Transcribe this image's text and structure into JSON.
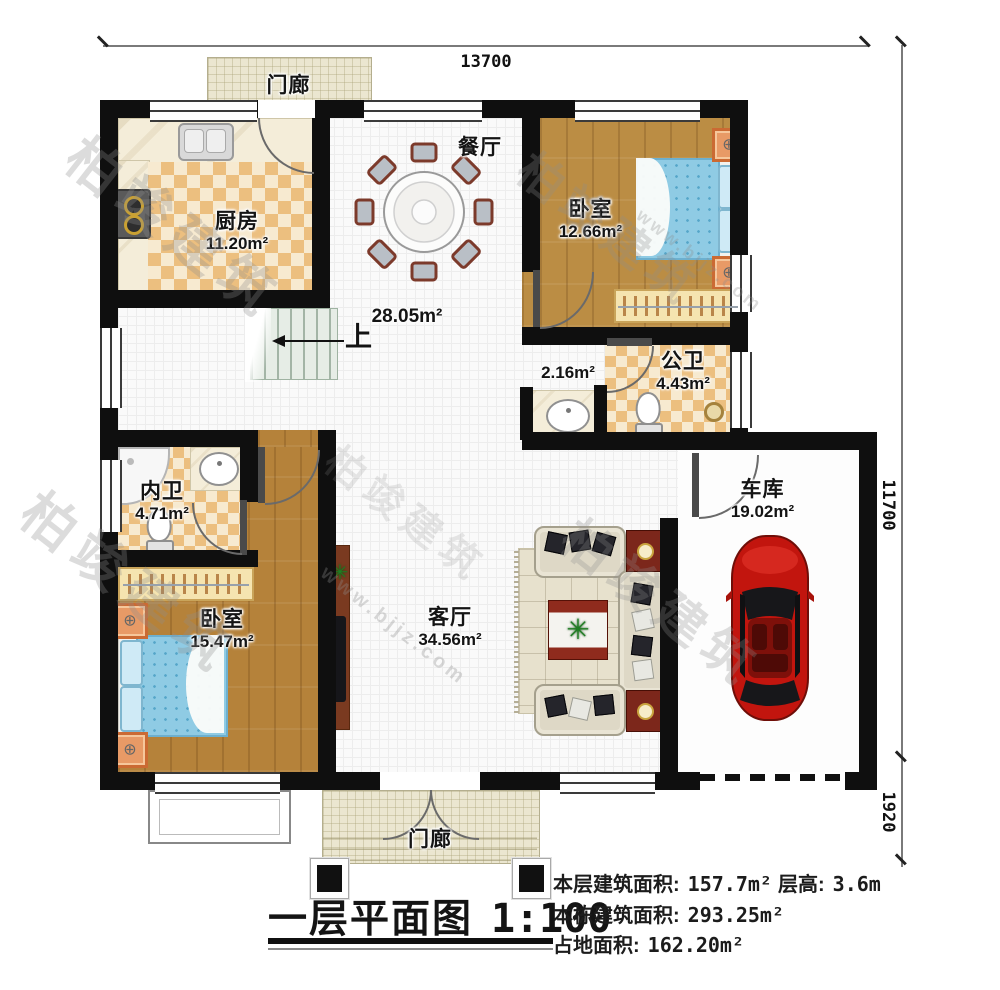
{
  "dimensions": {
    "width_top": "13700",
    "height_right": "11700",
    "porch_depth_right": "1920"
  },
  "rooms": [
    {
      "key": "porch-top",
      "name": "门廊",
      "area": ""
    },
    {
      "key": "kitchen",
      "name": "厨房",
      "area": "11.20m²"
    },
    {
      "key": "dining",
      "name": "餐厅",
      "area": "28.05m²"
    },
    {
      "key": "bedroom-top-right",
      "name": "卧室",
      "area": "12.66m²"
    },
    {
      "key": "bath-public",
      "name": "公卫",
      "area": "4.43m²"
    },
    {
      "key": "vanity",
      "name": "",
      "area": "2.16m²"
    },
    {
      "key": "garage",
      "name": "车库",
      "area": "19.02m²"
    },
    {
      "key": "bath-ensuite",
      "name": "内卫",
      "area": "4.71m²"
    },
    {
      "key": "bedroom-bottom-left",
      "name": "卧室",
      "area": "15.47m²"
    },
    {
      "key": "living",
      "name": "客厅",
      "area": "34.56m²"
    },
    {
      "key": "porch-bottom",
      "name": "门廊",
      "area": ""
    }
  ],
  "stairs": {
    "up_label": "上"
  },
  "title_block": {
    "title": "一层平面图",
    "scale": "1:100"
  },
  "stats": {
    "floor_area_label": "本层建筑面积:",
    "floor_area_value": "157.7m²",
    "storey_height_label": "层高:",
    "storey_height_value": "3.6m",
    "building_area_label": "本栋建筑面积:",
    "building_area_value": "293.25m²",
    "footprint_label": "占地面积:",
    "footprint_value": "162.20m²"
  },
  "watermark": {
    "text": "柏竣建筑",
    "subtext": "www.bjjz.com"
  }
}
